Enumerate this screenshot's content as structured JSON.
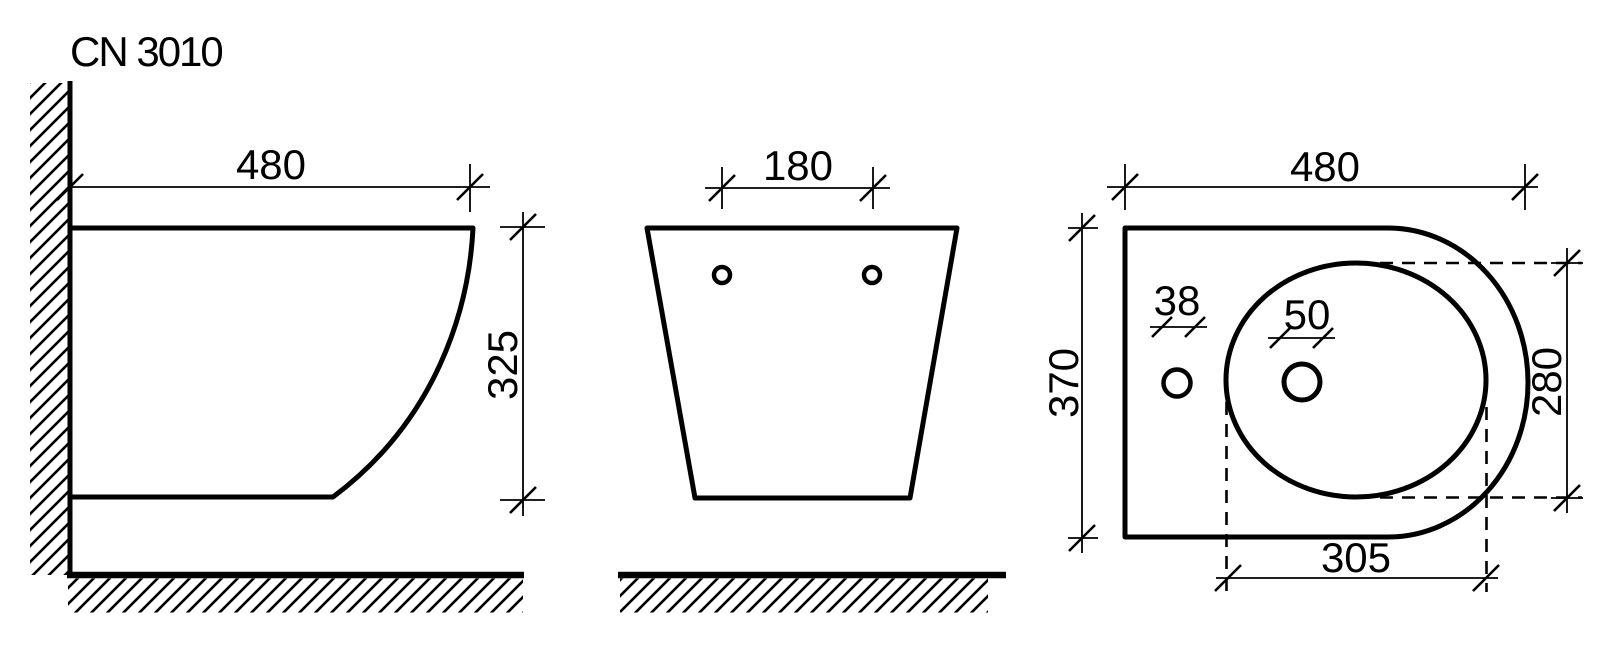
{
  "title": "CN 3010",
  "drawing_type": "technical-dimension-drawing",
  "colors": {
    "ink": "#000000",
    "paper": "#ffffff"
  },
  "views": {
    "side": {
      "name": "side-view",
      "dims": {
        "width": "480",
        "height": "325"
      }
    },
    "front": {
      "name": "front-view",
      "dims": {
        "hole_spacing": "180"
      }
    },
    "plan": {
      "name": "plan-view",
      "dims": {
        "length": "480",
        "width": "370",
        "faucet_hole": "38",
        "drain_hole": "50",
        "bowl_width": "280",
        "bowl_length": "305"
      }
    }
  }
}
